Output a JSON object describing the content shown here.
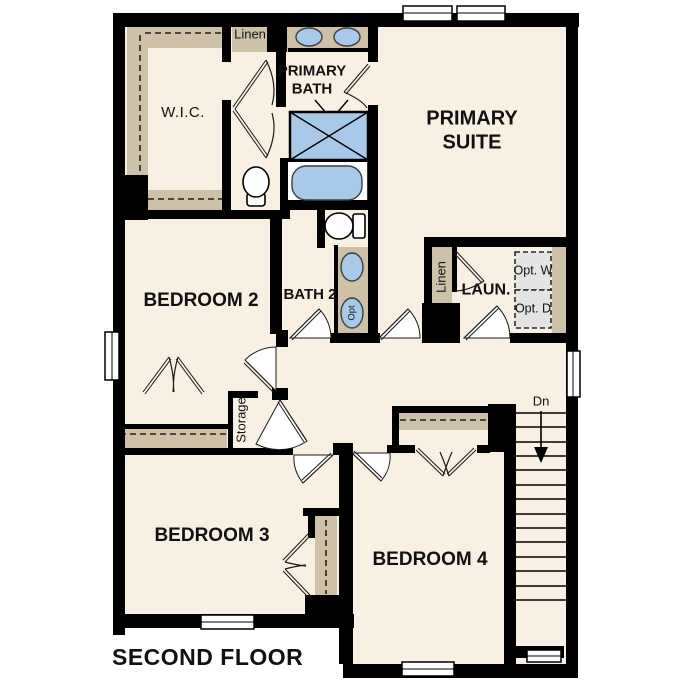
{
  "floor_plan": {
    "title": "SECOND FLOOR",
    "rooms": {
      "wic": "W.I.C.",
      "linen_top": "Linen",
      "primary_bath": "PRIMARY BATH",
      "primary_suite": "PRIMARY SUITE",
      "bedroom_2": "BEDROOM 2",
      "bath_2": "BATH 2",
      "laundry": "LAUN.",
      "laundry_linen": "Linen",
      "storage": "Storage",
      "bedroom_3": "BEDROOM 3",
      "bedroom_4": "BEDROOM 4"
    },
    "annotations": {
      "stairs_down": "Dn",
      "optional_washer": "Opt. W",
      "optional_dryer": "Opt. D",
      "optional_sink": "Opt"
    },
    "colors": {
      "background": "#ffffff",
      "floor": "#f7f0e3",
      "wall": "#000000",
      "casework": "#cdc1a8",
      "fixture": "#a9c9e9",
      "optional_appliance": "#e4e4e4"
    }
  }
}
